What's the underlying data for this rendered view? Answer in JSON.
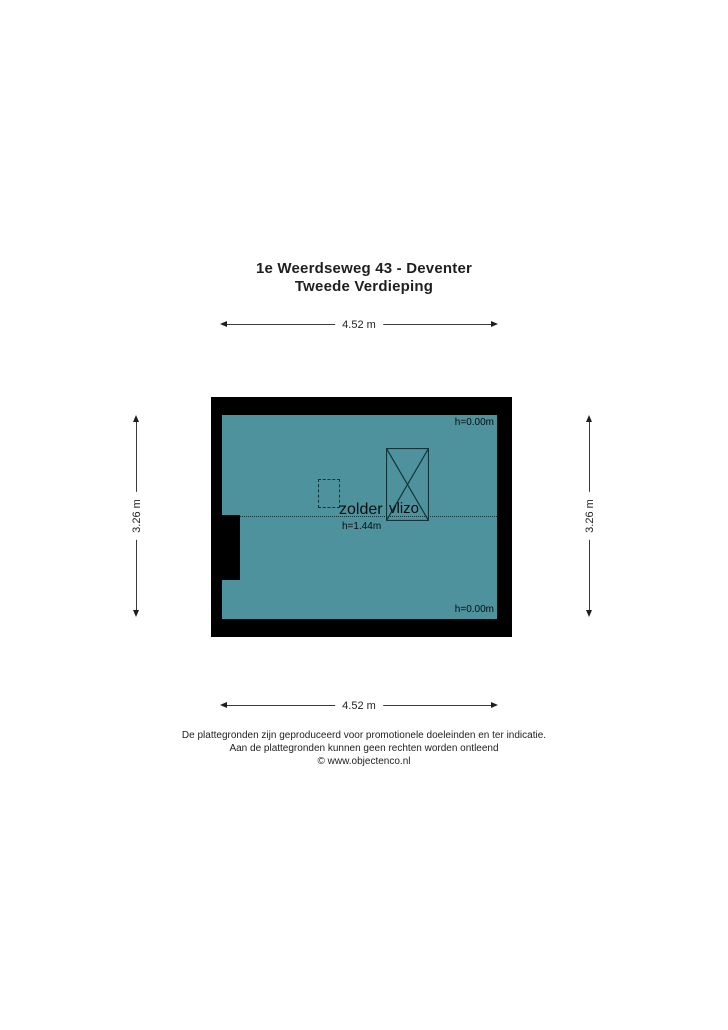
{
  "title": {
    "address": "1e Weerdseweg 43 - Deventer",
    "floor": "Tweede Verdieping"
  },
  "dimensions": {
    "top": "4.52 m",
    "bottom": "4.52 m",
    "left": "3.26 m",
    "right": "3.26 m"
  },
  "floorplan": {
    "room_label": "zolder",
    "room_height_label": "h=1.44m",
    "height_top_right": "h=0.00m",
    "height_bottom_right": "h=0.00m",
    "vlizo_label": "vlizo",
    "colors": {
      "floor": "#4e929d",
      "wall": "#000000"
    }
  },
  "footer": {
    "line1": "De plattegronden zijn geproduceerd voor promotionele doeleinden en ter indicatie.",
    "line2": "Aan de plattegronden kunnen geen rechten worden ontleend",
    "line3": "© www.objectenco.nl"
  }
}
